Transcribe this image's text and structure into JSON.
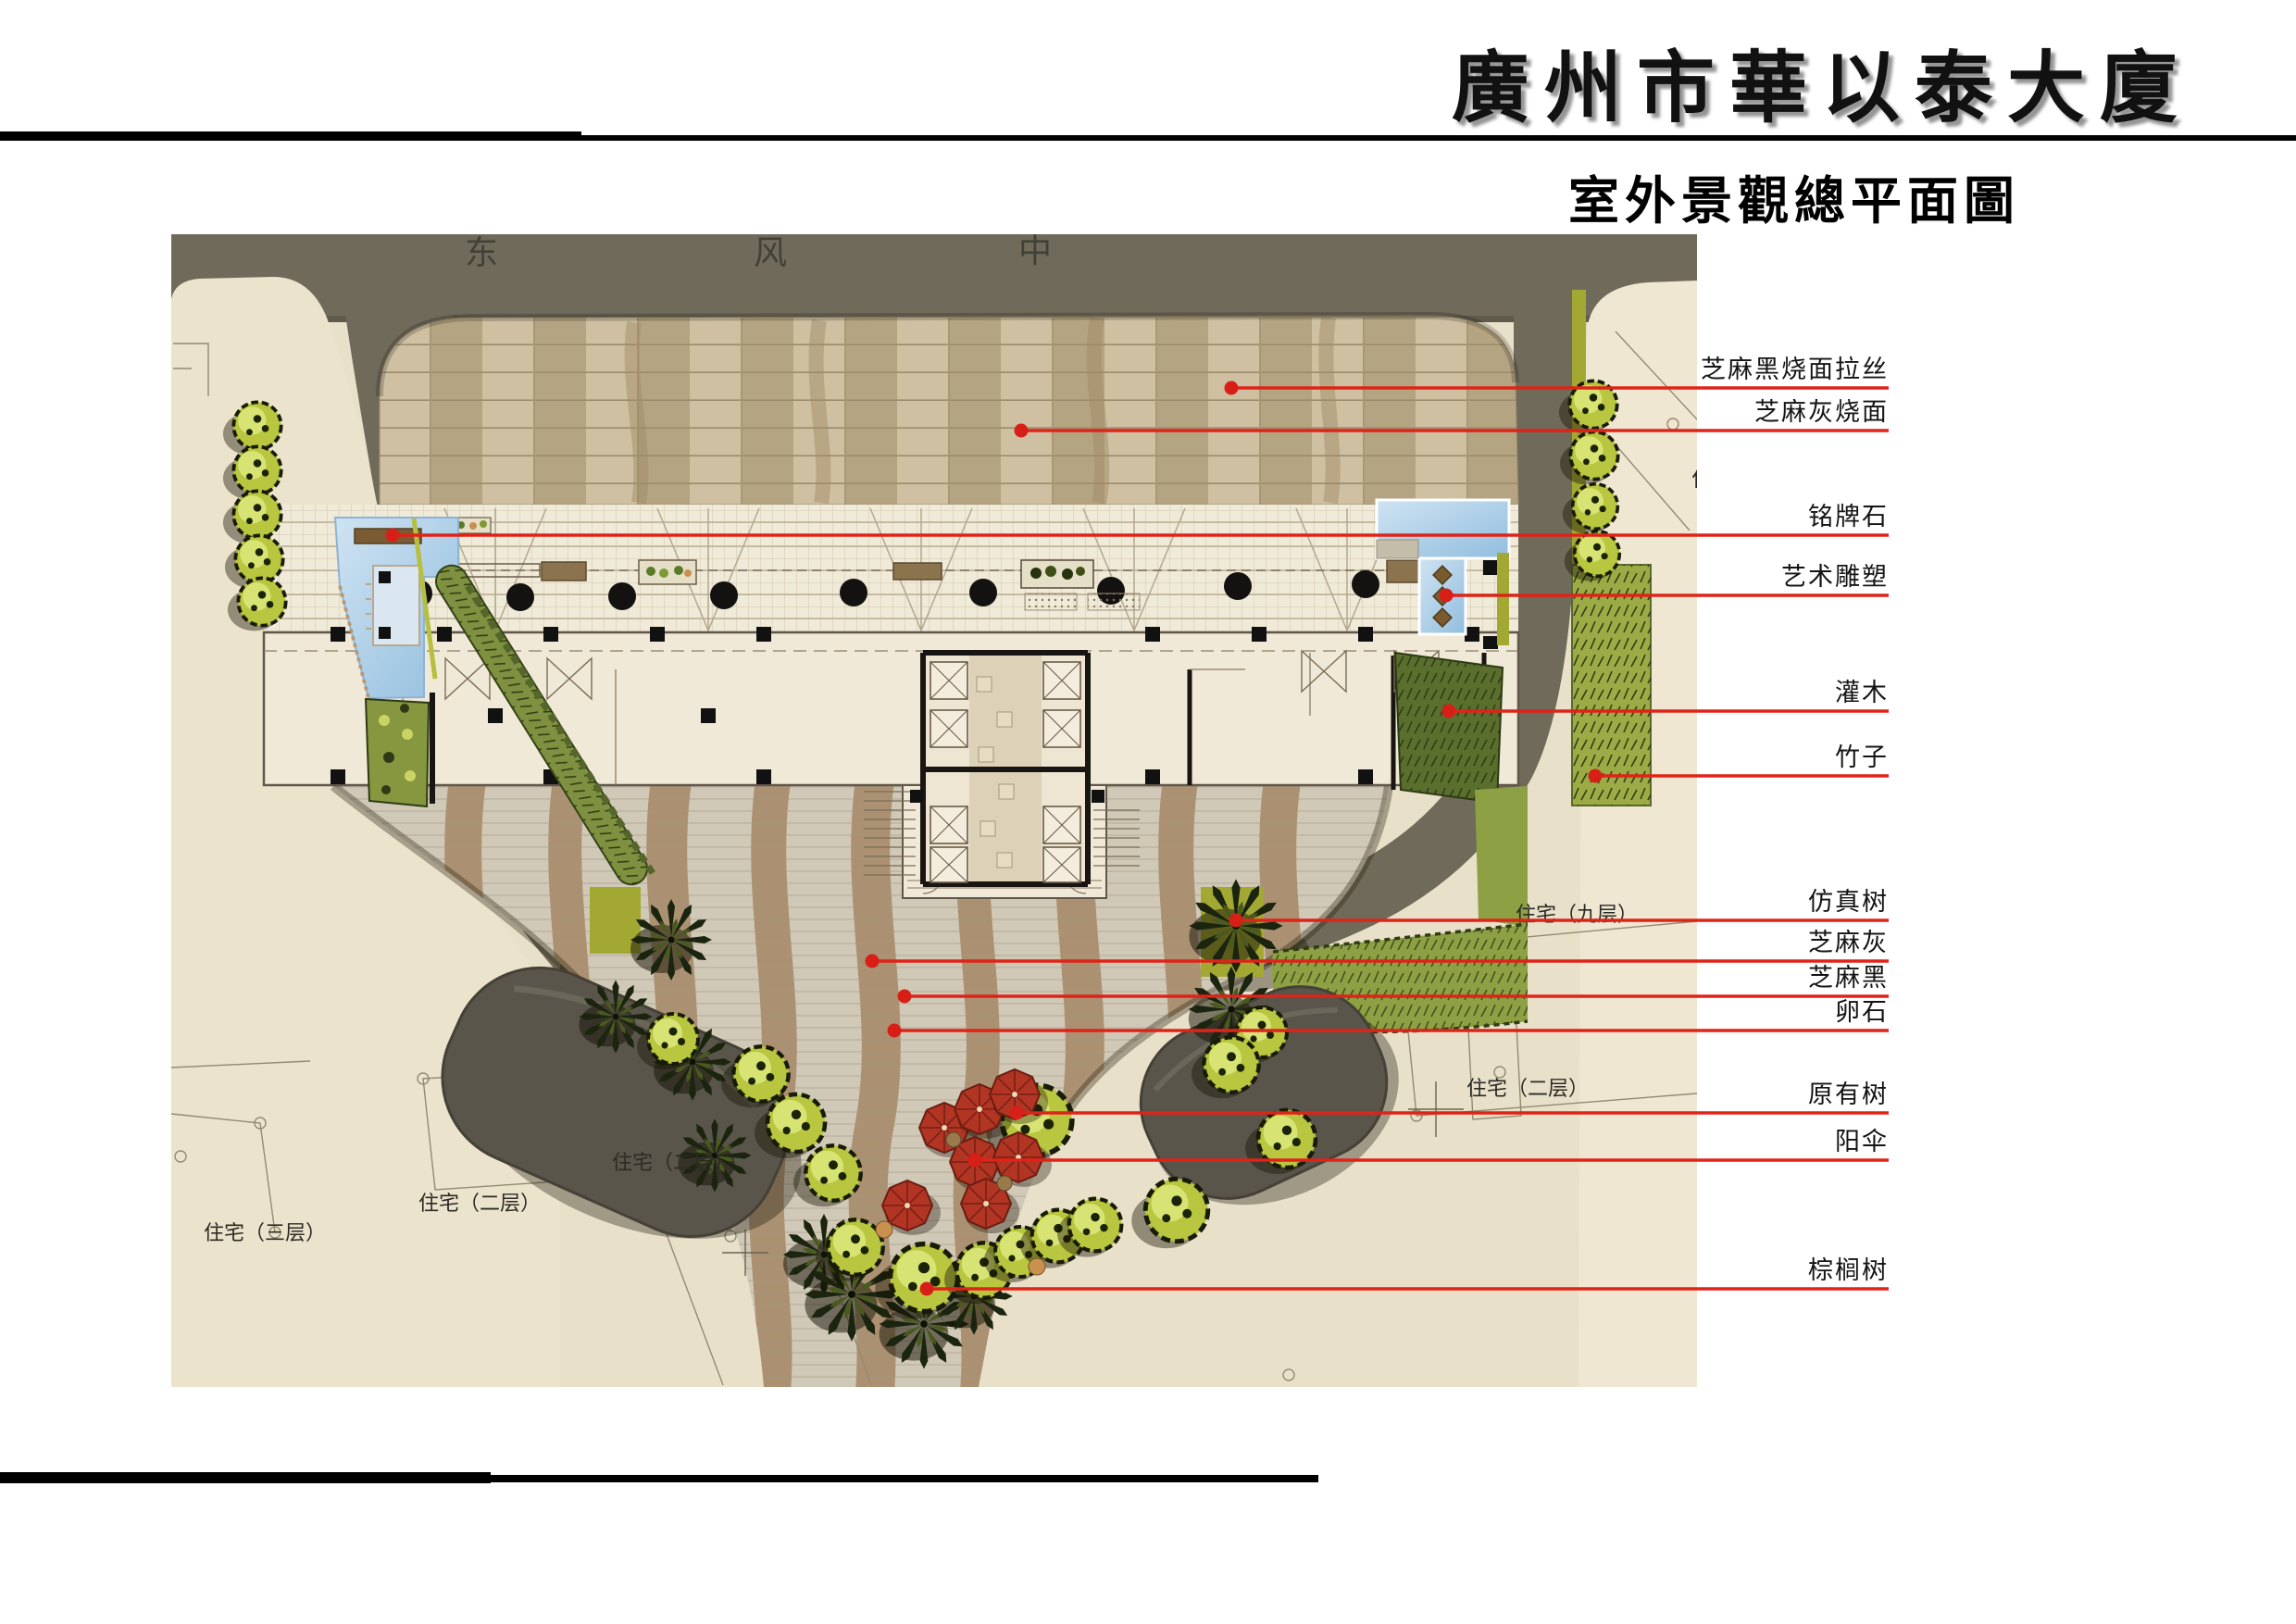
{
  "header": {
    "title": "廣州市華以泰大廈",
    "subtitle": "室外景觀總平面圖"
  },
  "street": {
    "c1": "东",
    "c2": "风",
    "c3": "中"
  },
  "site_labels": {
    "res9": "住宅（九层）",
    "res2_right": "住宅（二层）",
    "res2_mid": "住宅（二层）",
    "res2_left": "住宅（二层）",
    "res3": "住宅（三层）",
    "partial": "住宅"
  },
  "callouts": [
    {
      "label": "芝麻黑烧面拉丝"
    },
    {
      "label": "芝麻灰烧面"
    },
    {
      "label": "铭牌石"
    },
    {
      "label": "艺术雕塑"
    },
    {
      "label": "灌木"
    },
    {
      "label": "竹子"
    },
    {
      "label": "仿真树"
    },
    {
      "label": "芝麻灰"
    },
    {
      "label": "芝麻黑"
    },
    {
      "label": "卵石"
    },
    {
      "label": "原有树"
    },
    {
      "label": "阳伞"
    },
    {
      "label": "棕榈树"
    }
  ],
  "colors": {
    "accent_red": "#e02318",
    "road": "#6f6a59",
    "plaza_dark": "#b5a481",
    "plaza_light": "#cec0a1",
    "water": "#a9cdea",
    "leaf": "#b9c63f",
    "umbrella": "#b23524",
    "canopy": "#59554a",
    "base_beige": "#e9e0ca"
  }
}
